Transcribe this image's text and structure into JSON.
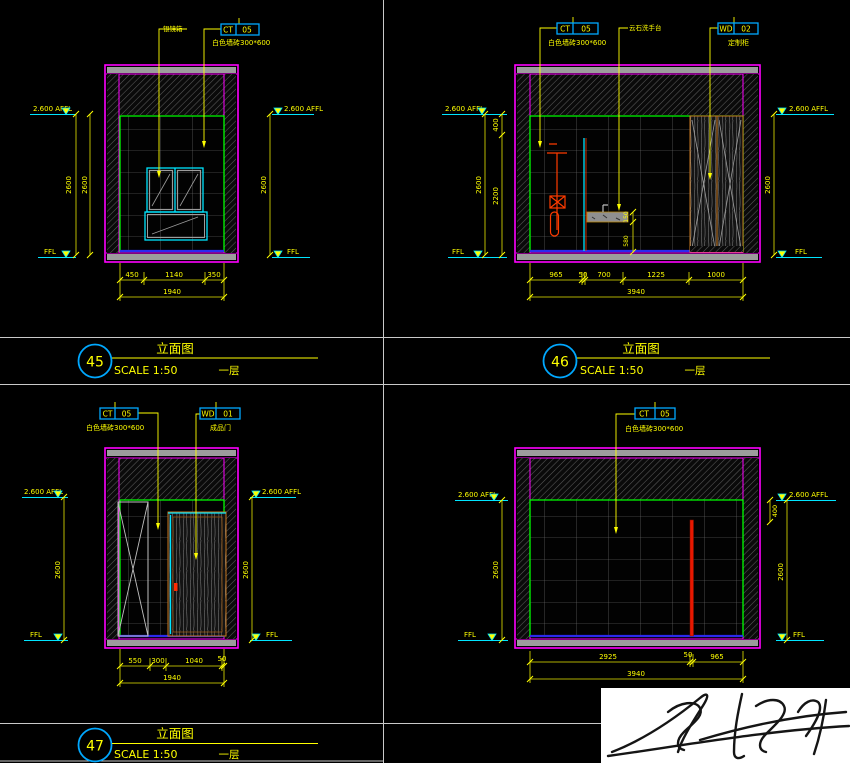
{
  "colors": {
    "background": "#000000",
    "wall_magenta": "#ff00ff",
    "dimension_yellow": "#ffff00",
    "level_cyan": "#00e5ff",
    "tile_edge_green": "#00ff00",
    "floor_blue": "#2a2aee",
    "fixture_red": "#ff3b00",
    "slab_gray": "#9c9c9c",
    "tag_border_cyan": "#00a8ff",
    "signature_paper": "#ffffff"
  },
  "panels": [
    {
      "number": "45",
      "title": "立面图",
      "scale": "SCALE 1:50",
      "floor": "一层",
      "tags": [
        {
          "code": "CT",
          "num": "05",
          "note": "白色墙砖300*600"
        }
      ],
      "callouts": [
        "银镜箱"
      ],
      "levels": {
        "affl": "2.600 AFFL",
        "ffl": "FFL"
      },
      "dims": {
        "left": [
          "2600",
          "2600"
        ],
        "right": [
          "2600"
        ],
        "bottom": [
          "450",
          "1140",
          "350"
        ],
        "total": "1940"
      }
    },
    {
      "number": "46",
      "title": "立面图",
      "scale": "SCALE 1:50",
      "floor": "一层",
      "tags": [
        {
          "code": "CT",
          "num": "05",
          "note": "白色墙砖300*600"
        },
        {
          "code": "WD",
          "num": "02",
          "note": "定制柜"
        }
      ],
      "callouts": [
        "云石洗手台"
      ],
      "levels": {
        "affl": "2.600 AFFL",
        "ffl": "FFL"
      },
      "dims": {
        "left": [
          "2600"
        ],
        "left_inner": [
          "400",
          "2200"
        ],
        "right": [
          "2600"
        ],
        "basin": [
          "150",
          "580"
        ],
        "bottom": [
          "965",
          "50",
          "700",
          "1225",
          "1000"
        ],
        "total": "3940"
      }
    },
    {
      "number": "47",
      "title": "立面图",
      "scale": "SCALE 1:50",
      "floor": "一层",
      "tags": [
        {
          "code": "CT",
          "num": "05",
          "note": "白色墙砖300*600"
        },
        {
          "code": "WD",
          "num": "01",
          "note": "成品门"
        }
      ],
      "callouts": [],
      "levels": {
        "affl": "2.600 AFFL",
        "ffl": "FFL"
      },
      "dims": {
        "left": [
          "2600"
        ],
        "right": [
          "2600"
        ],
        "bottom": [
          "550",
          "300",
          "1040",
          "50"
        ],
        "total": "1940"
      }
    },
    {
      "number": "",
      "title": "",
      "scale": "",
      "floor": "",
      "tags": [
        {
          "code": "CT",
          "num": "05",
          "note": "白色墙砖300*600"
        }
      ],
      "callouts": [],
      "levels": {
        "affl": "2.600 AFFL",
        "ffl": "FFL"
      },
      "dims": {
        "left": [
          "2600"
        ],
        "right": [
          "2600"
        ],
        "right_inner": [
          "400"
        ],
        "bottom": [
          "2925",
          "50",
          "965"
        ],
        "total": "3940"
      }
    }
  ]
}
